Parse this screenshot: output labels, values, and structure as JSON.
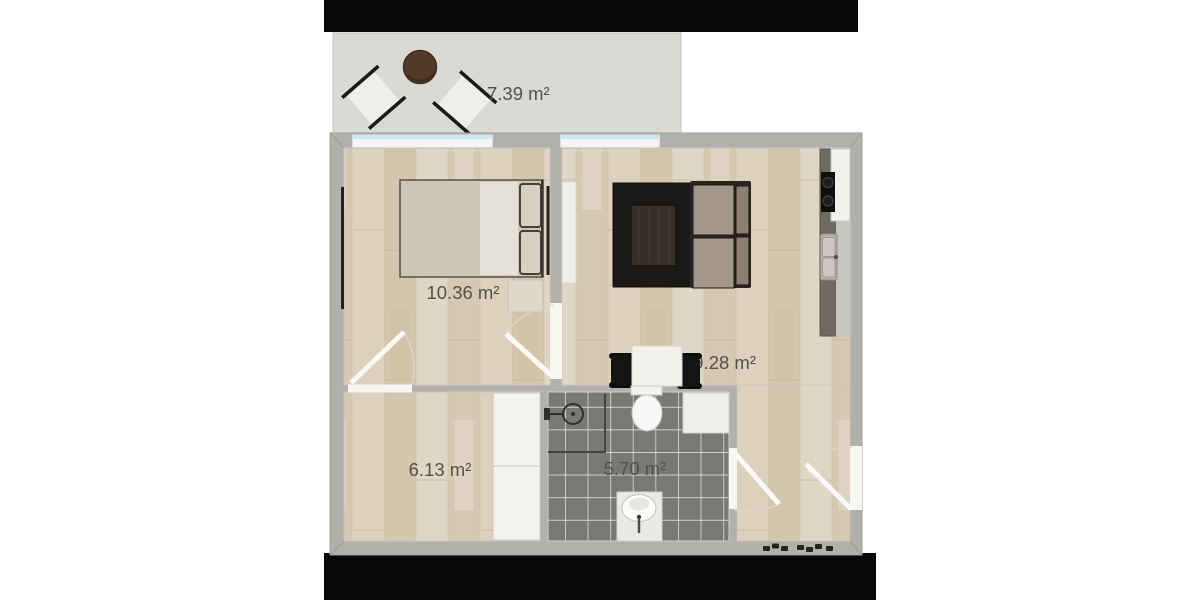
{
  "floor_plan": {
    "rooms": [
      {
        "name": "balcony",
        "area_label": "7.39 m²",
        "furniture": [
          "round-table",
          "chair",
          "chair"
        ]
      },
      {
        "name": "bedroom",
        "area_label": "10.36 m²",
        "furniture": [
          "double-bed",
          "pillows",
          "nightstand",
          "radiator",
          "radiator"
        ]
      },
      {
        "name": "living-room-kitchen",
        "area_label": "19.28 m²",
        "furniture": [
          "rug",
          "coffee-table",
          "sofa",
          "dining-table",
          "dining-chair",
          "dining-chair",
          "kitchen-counter",
          "cooktop",
          "sink",
          "fridge",
          "shelf"
        ]
      },
      {
        "name": "hallway",
        "area_label": "6.13 m²",
        "furniture": [
          "wardrobe"
        ]
      },
      {
        "name": "bathroom",
        "area_label": "5.70 m²",
        "furniture": [
          "shower",
          "toilet",
          "washbasin",
          "cabinet"
        ]
      }
    ],
    "colors": {
      "page_background": "#ffffff",
      "letterbox": "#070707",
      "wall": "#b1b0ad",
      "wood_floor": "#d9cdb7",
      "tile_floor": "#787875",
      "balcony_floor": "#dad9d4",
      "window_glass": "#cde7ea",
      "label_text": "#54514b"
    }
  }
}
